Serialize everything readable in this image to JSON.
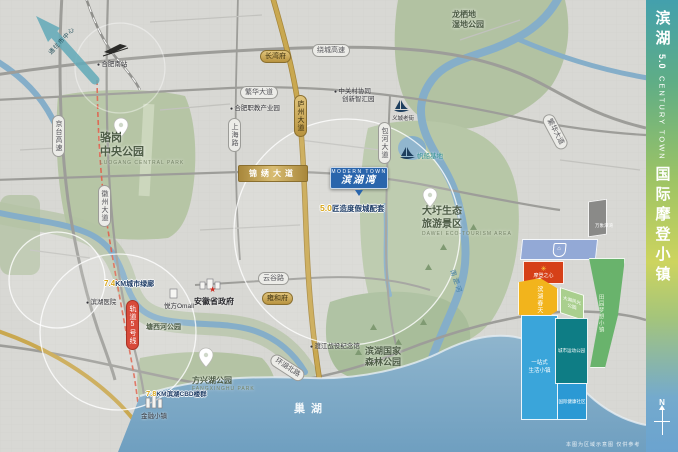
{
  "sidebar": {
    "brand_cn_1": "滨湖",
    "brand_num": "5.0",
    "brand_en": "CENTURY TOWN",
    "brand_cn_2": "国际摩登小镇",
    "compass": "N"
  },
  "project": {
    "flag_en": "MODERN TOWN",
    "flag_cn": "滨湖湾",
    "banner_num": "5.0",
    "banner_text": "匠造度假城配套"
  },
  "banners": {
    "greenway_num": "7.4",
    "greenway_text": "KM城市绿廊",
    "cbd_num": "7.8",
    "cbd_text": "KM滨湖CBD楼群"
  },
  "arrow": {
    "label": "通往市中心"
  },
  "parks": {
    "luogang1": "骆岗",
    "luogang2": "中央公园",
    "luogang_en": "LUOGANG CENTRAL PARK",
    "longqidi1": "龙栖地",
    "longqidi2": "湿地公园",
    "dawei1": "大圩生态",
    "dawei2": "旅游景区",
    "dawei_en": "DAWEI ECO-TOURISM AREA",
    "forest1": "滨湖国家",
    "forest2": "森林公园",
    "fangxing": "方兴湖公园",
    "fangxing_en": "FANGXINGHU PARK",
    "tangxi": "塘西河公园"
  },
  "water": {
    "chaohu": "巢湖",
    "nanfeihe": "南淝河"
  },
  "roads": {
    "raocheng": "绕城高速",
    "fanhua_w": "繁华大道",
    "fanhua_e": "繁华大道",
    "jinxiu": "锦绣大道",
    "yungu": "云谷路",
    "huanhu": "环湖北路",
    "jingtai": "京台高速",
    "huizhou": "徽州大道",
    "luzhou": "庐州大道",
    "shanghai": "上海路",
    "baohe": "包河大道",
    "metro": "轨道5号线"
  },
  "pois": {
    "station": "合肥南站",
    "government": "安徽省政府",
    "hospital": "滨湖医院",
    "mall": "悦方Omall",
    "zgc1": "中关村协同",
    "zgc2": "创新智汇园",
    "vocational": "合肥职教产业园",
    "memorial": "渡江战役纪念馆",
    "yicheng": "义城老街",
    "marina": "帆船基地",
    "finance": "金融小镇"
  },
  "estates": {
    "e1": "长湾府",
    "e2": "雍和府"
  },
  "inset": {
    "side_label": "万象潭湾",
    "red_label": "摩登之心",
    "yellow_label": "滨湖春天",
    "strip_label": "大湖风光公园",
    "green_label": "田园梦想小镇",
    "lightblue1": "一站式",
    "lightblue2": "生活小镇",
    "teal_label": "城市运动公园",
    "medblue_label": "国际健康社区"
  },
  "footer": {
    "disclaimer": "本图为区域示意图 仅供参考"
  },
  "colors": {
    "brand_blue": "#2a65ac",
    "road_gold": "#c3a350",
    "park_green": "#b6c5a5",
    "water_blue": "#85aec9",
    "metro_red": "#dd6a55",
    "sidebar_top": "#43a0ad",
    "sidebar_mid": "#cdd45f",
    "sidebar_bottom": "#6ba3cf"
  }
}
